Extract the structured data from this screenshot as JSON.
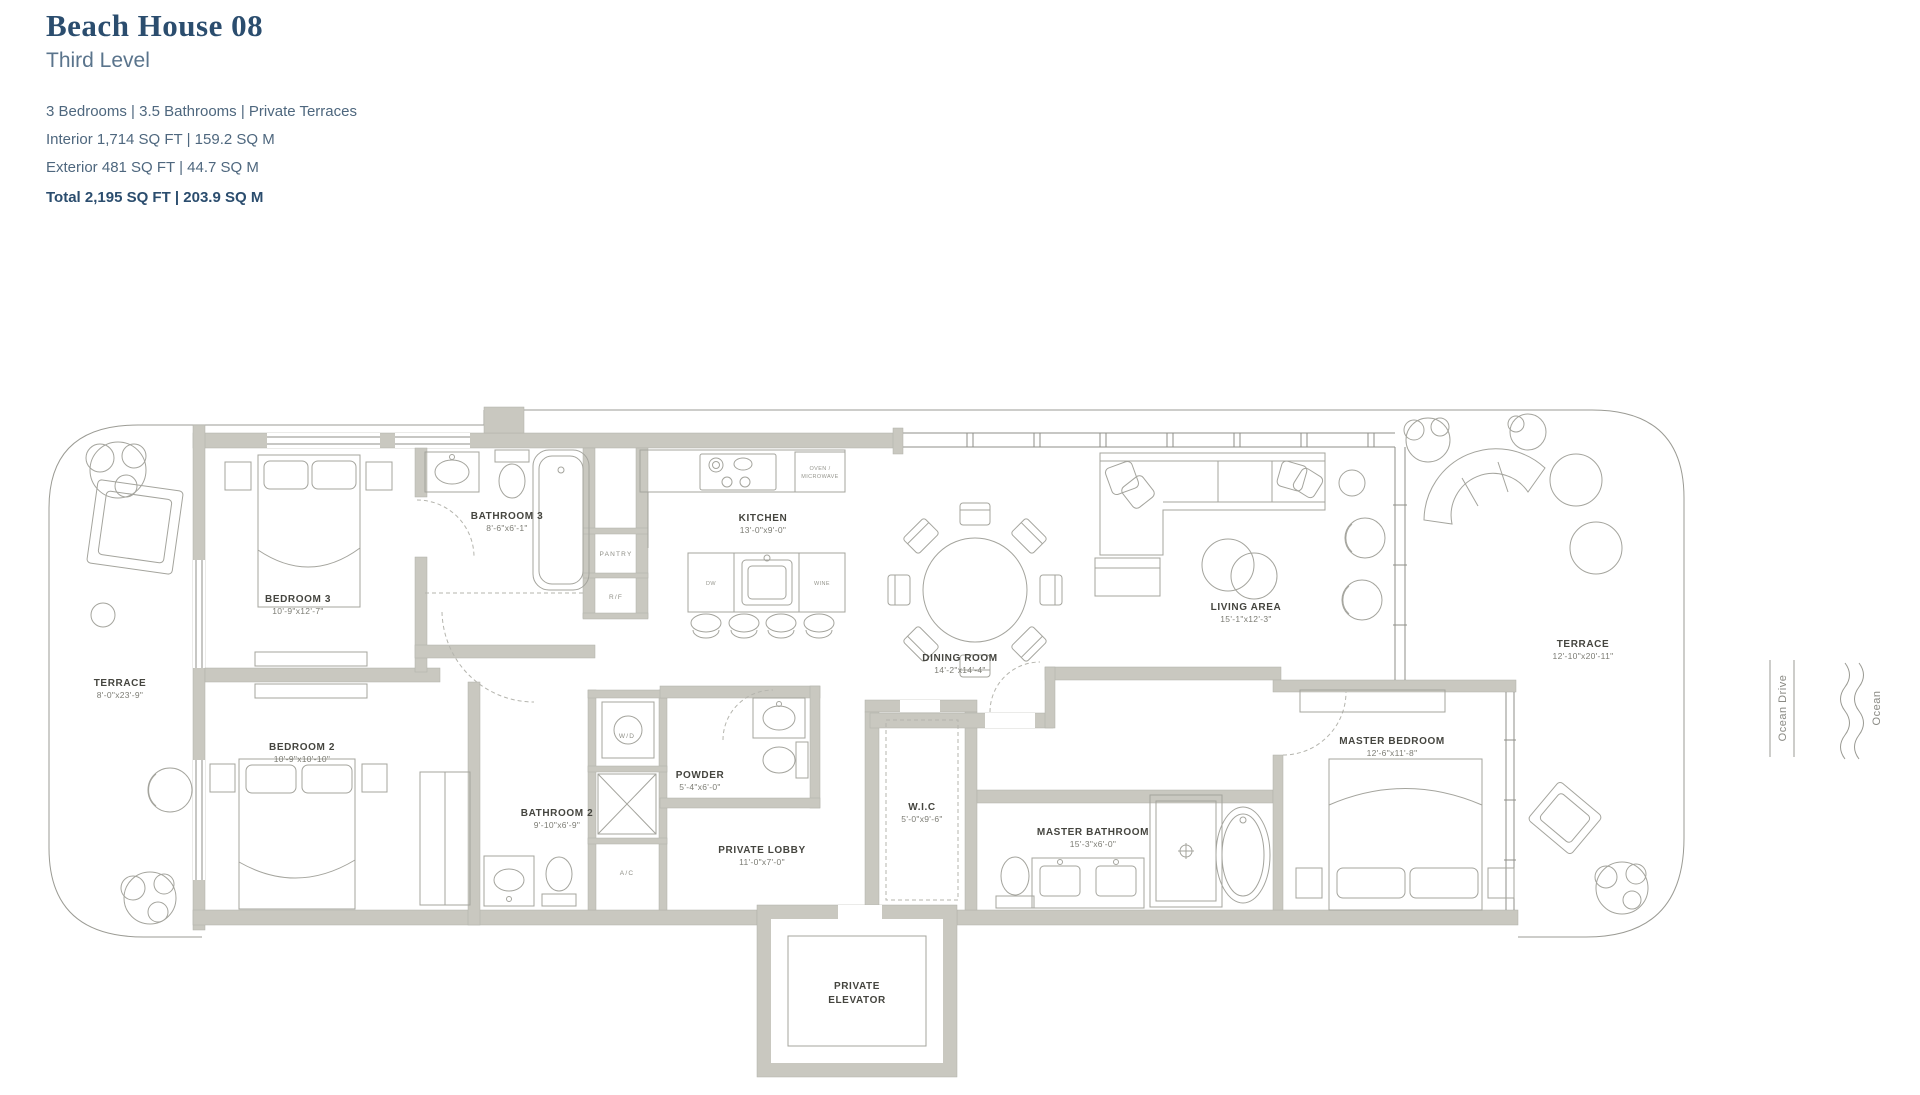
{
  "header": {
    "title": "Beach House 08",
    "subtitle": "Third Level",
    "specs_line1": "3 Bedrooms  |  3.5 Bathrooms  |  Private Terraces",
    "specs_line2": "Interior 1,714 SQ FT  |  159.2 SQ M",
    "specs_line3": "Exterior 481 SQ FT  |  44.7 SQ M",
    "specs_total": "Total 2,195 SQ FT  |  203.9 SQ M"
  },
  "colors": {
    "accent": "#2b4d6e",
    "wall_gray": "#c9c8c0",
    "label_dark": "#45453f"
  },
  "floorplan": {
    "rooms": {
      "terrace_left": {
        "name": "TERRACE",
        "dims": "8'-0\"x23'-9\""
      },
      "bedroom3": {
        "name": "BEDROOM 3",
        "dims": "10'-9\"x12'-7\""
      },
      "bathroom3": {
        "name": "BATHROOM 3",
        "dims": "8'-6\"x6'-1\""
      },
      "kitchen": {
        "name": "KITCHEN",
        "dims": "13'-0\"x9'-0\""
      },
      "dining_room": {
        "name": "DINING ROOM",
        "dims": "14'-2\"x14'-4\""
      },
      "living_area": {
        "name": "LIVING AREA",
        "dims": "15'-1\"x12'-3\""
      },
      "terrace_right": {
        "name": "TERRACE",
        "dims": "12'-10\"x20'-11\""
      },
      "bedroom2": {
        "name": "BEDROOM 2",
        "dims": "10'-9\"x10'-10\""
      },
      "bathroom2": {
        "name": "BATHROOM 2",
        "dims": "9'-10\"x6'-9\""
      },
      "powder": {
        "name": "POWDER",
        "dims": "5'-4\"x6'-0\""
      },
      "private_lobby": {
        "name": "PRIVATE LOBBY",
        "dims": "11'-0\"x7'-0\""
      },
      "wic": {
        "name": "W.I.C",
        "dims": "5'-0\"x9'-6\""
      },
      "master_bathroom": {
        "name": "MASTER BATHROOM",
        "dims": "15'-3\"x6'-0\""
      },
      "master_bedroom": {
        "name": "MASTER BEDROOM",
        "dims": "12'-6\"x11'-8\""
      },
      "private_elevator": {
        "line1": "PRIVATE",
        "line2": "ELEVATOR"
      }
    },
    "small_labels": {
      "pantry": "PANTRY",
      "rf": "R/F",
      "wd": "W/D",
      "ac": "A/C",
      "dw": "DW",
      "wine": "WINE",
      "oven1": "OVEN /",
      "oven2": "MICROWAVE"
    },
    "context": {
      "street": "Ocean Drive",
      "water": "Ocean"
    }
  }
}
